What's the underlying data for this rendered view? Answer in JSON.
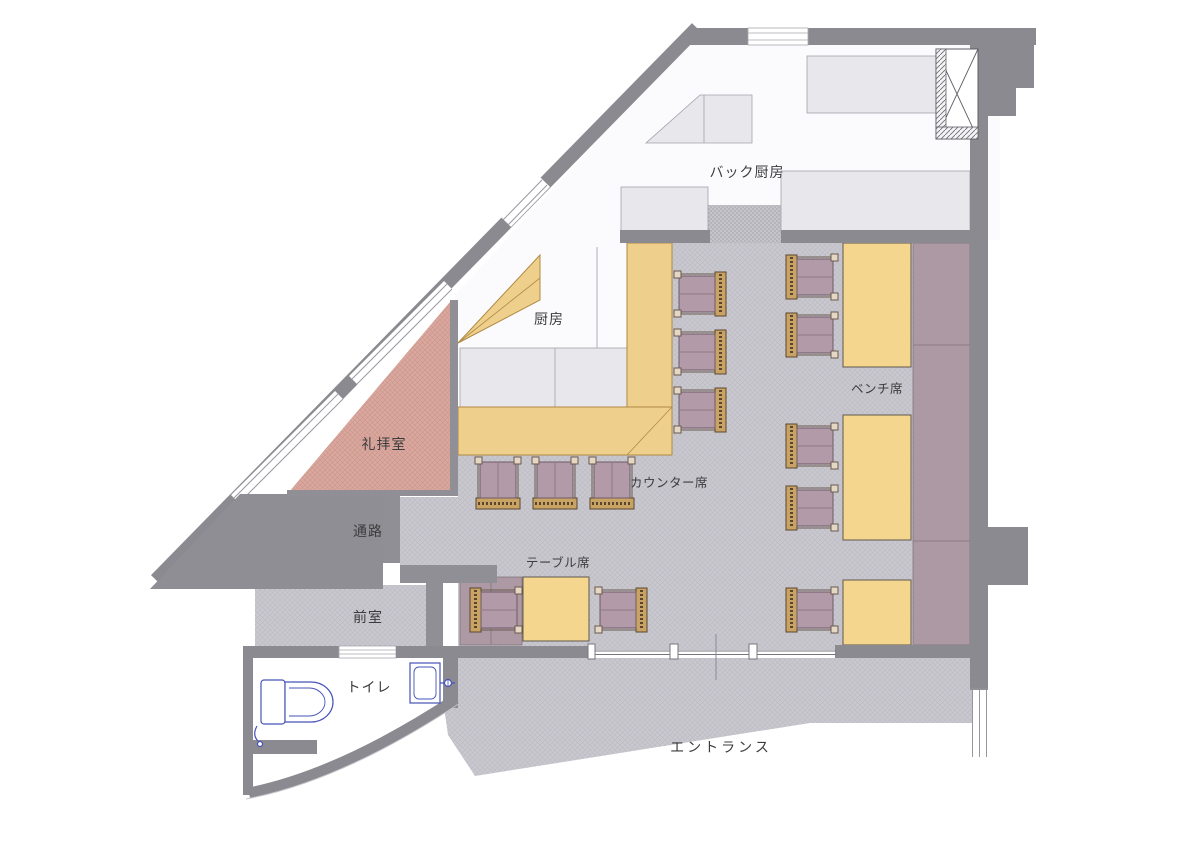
{
  "title": "Restaurant floor plan",
  "labels": {
    "back_kitchen": "バック厨房",
    "kitchen": "厨房",
    "prayer_room": "礼拝室",
    "corridor": "通路",
    "anteroom": "前室",
    "toilet": "トイレ",
    "counter_seats": "カウンター席",
    "table_seats": "テーブル席",
    "bench_seats": "ベンチ席",
    "entrance": "エントランス"
  },
  "palette": {
    "wall_gray": "#8b8a90",
    "inner_wall_gray": "#918f96",
    "floor_gray": "#c9c8ce",
    "equipment_gray": "#e8e7ec",
    "kitchen_white": "#fbfbfd",
    "counter_yellow": "#eed08c",
    "table_yellow": "#f4d68e",
    "prayer_pink": "#d9a89e",
    "chair_seat_mauve": "#b29aa8",
    "chair_back_tan": "#c9a364",
    "bench_mauve": "#ac99a3",
    "fixture_blue": "#4553b8"
  },
  "furniture": {
    "counter_stools": 3,
    "counter_chairs": 3,
    "table_chairs": 2,
    "bench_side_chairs": 5,
    "bench_tables": 3,
    "floor_tables": 1,
    "benches": 2,
    "toilets": 1,
    "sinks": 1
  }
}
